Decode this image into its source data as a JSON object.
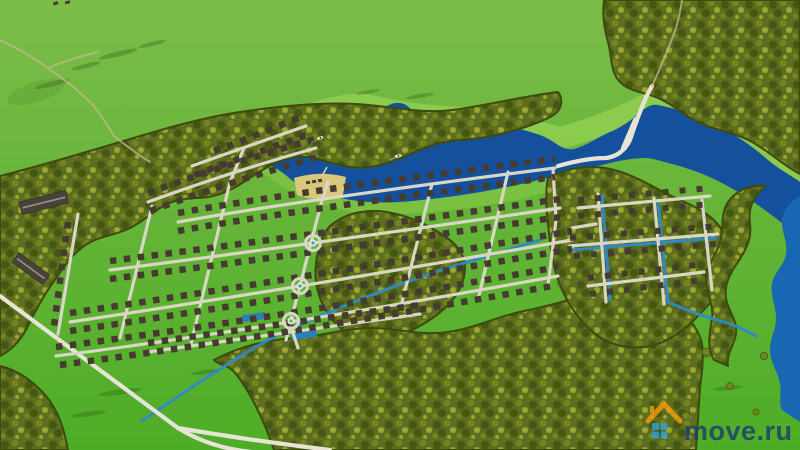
{
  "watermark": {
    "text": "move.ru",
    "icon": "house-logo"
  },
  "scene": {
    "features": [
      "meadow fields",
      "mixed forest belts",
      "lake with boats",
      "river along right edge",
      "cottage village street grid",
      "roundabouts",
      "irrigation canals and ponds",
      "sand beach",
      "farm barns",
      "country roads"
    ],
    "counts": {
      "roundabouts": 3,
      "boats": 2,
      "barns": 2,
      "ponds": 2
    }
  },
  "colors": {
    "field_top": "#7cbd4a",
    "field_mid": "#64b437",
    "field_bottom": "#4ead27",
    "meadow_shore": "#8ccb4f",
    "meadow_shore_south": "#7fc445",
    "forest_base": "#5e6e20",
    "forest_dark": "#465711",
    "forest_mid": "#74851f",
    "forest_light": "#9aa92e",
    "forest_edge": "#3d4b0e",
    "tree_shadow": "#2c5713",
    "lake": "#15509d",
    "river": "#1767b2",
    "canal": "#2f8ac8",
    "pond": "#2b7fb5",
    "street": "#d9d6c6",
    "road": "#e7e4d5",
    "dirt_path": "#c2b98b",
    "house_roof": "#453c2f",
    "barn_roof": "#47423a",
    "barn_ridge": "#979186",
    "sand": "#d9c87b",
    "pier": "#e2d396",
    "roundabout_center": "#e8e6da",
    "fountain": "#2fa5d8",
    "boat_hull": "#f2f1e6",
    "boat_dark": "#2e2b24",
    "vehicle": "#3f4038",
    "watermark_text": "#1d3e6e",
    "watermark_roof": "#f49a0c",
    "watermark_squares": "#2fa5d8"
  }
}
